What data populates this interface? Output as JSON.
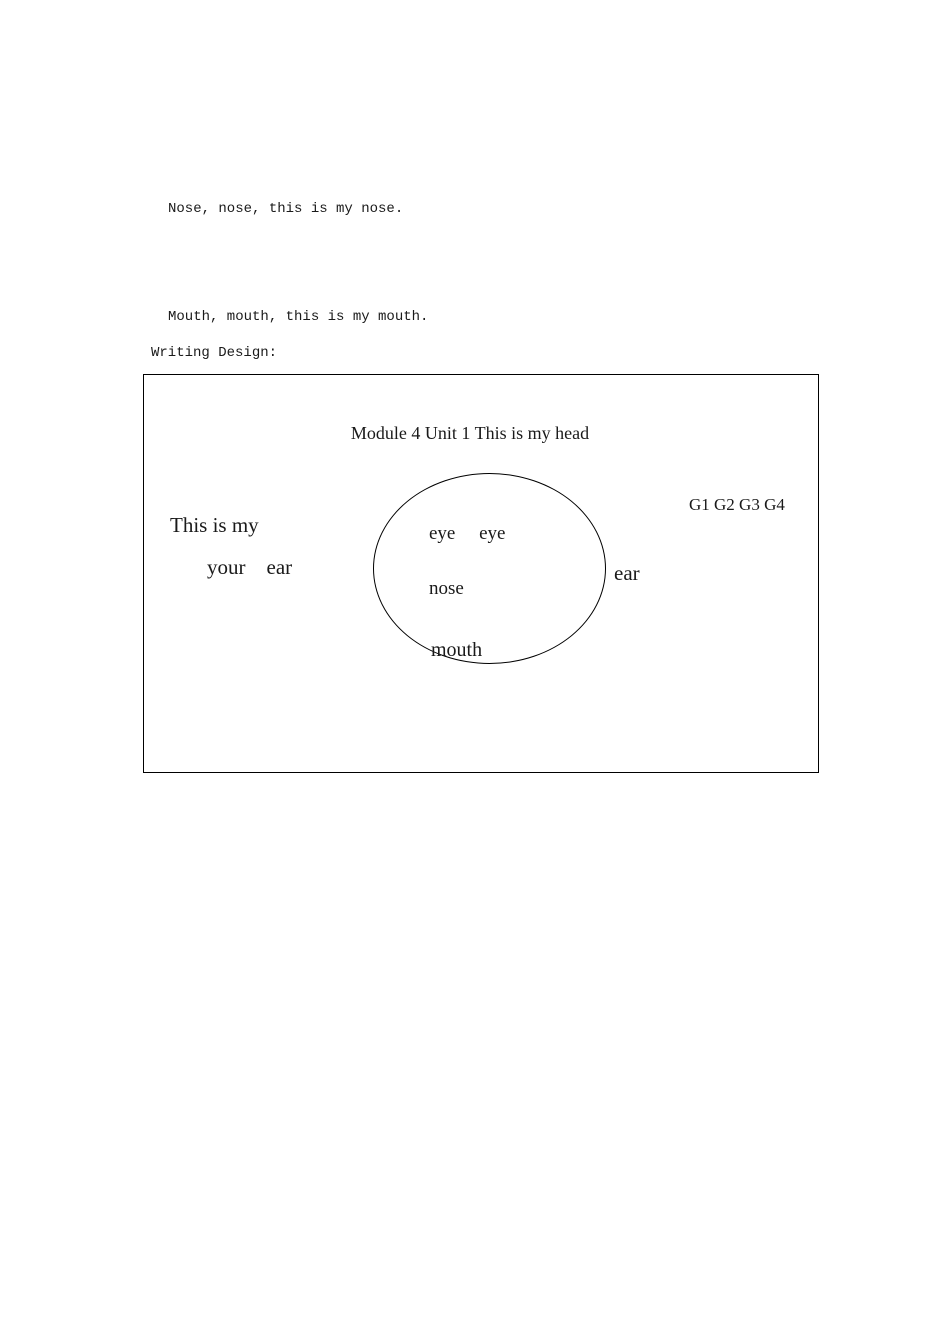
{
  "colors": {
    "background": "#ffffff",
    "text": "#1a1a1a",
    "border": "#000000"
  },
  "chant": {
    "lines": [
      "Nose, nose, this is my nose.",
      "Mouth, mouth, this is my mouth.",
      "Ear, ear, this is my ear.",
      "The eyes, nose, mouth, ears, make a face, make a face.",
      "Aha, Aha, This is my head.",
      "This is my head."
    ]
  },
  "writing_design_label": "Writing Design:",
  "board": {
    "title": "Module 4 Unit 1 This is my head",
    "group_labels": "G1 G2 G3 G4",
    "left_phrase": "This is my",
    "left_words": "your    ear",
    "right_word": "ear",
    "face": {
      "eyes": "eye     eye",
      "nose": "nose",
      "mouth": "mouth"
    }
  }
}
